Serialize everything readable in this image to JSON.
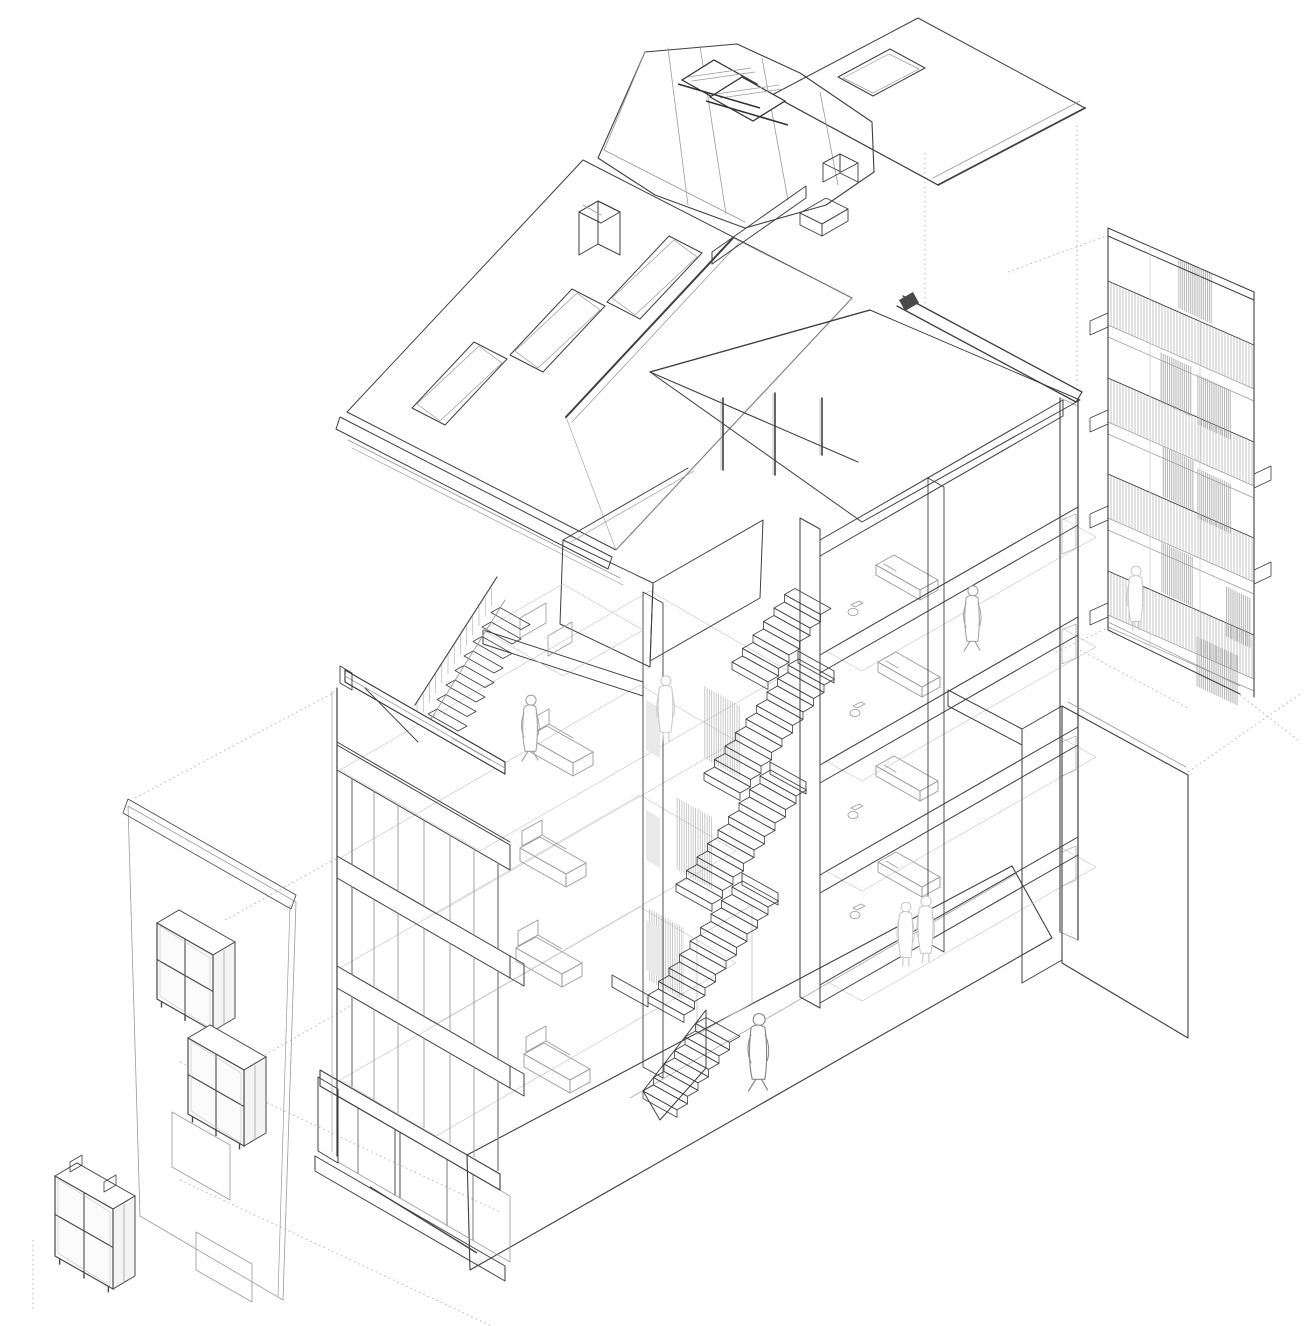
{
  "scene": {
    "title": "Exploded axonometric cutaway drawing of a multi-storey apartment building",
    "type": "architectural line drawing, no text labels",
    "background_color": "#ffffff",
    "ink_color": "#3f3f3f",
    "light_ink_color": "#9a9a9a",
    "faint_ink_color": "#c4c4c4",
    "projection_line_style": "dotted"
  },
  "components": {
    "roof_assembly": {
      "front_tiled_pitch": {
        "skylights": 3,
        "chimneys": 1,
        "tile_type": "scalloped clay tiles",
        "gutter_boards": 2
      },
      "attic_dormer_volume": {
        "finish": "hatched shingle cladding",
        "roof_window_frames": 2,
        "chimney_boxes": 1
      },
      "rear_tiled_pitch": {
        "skylights": 1
      },
      "eaves_beam_bar": 1
    },
    "balcony_screen_facade": {
      "levels": 4,
      "railing": "vertical slat balustrades",
      "louver_screen_panels": 8,
      "support_brackets": true,
      "people_on_balconies": 1
    },
    "main_building": {
      "left_wing": {
        "floors": 4,
        "roof_terrace": true,
        "terrace_parapet": true,
        "loft_stair": true,
        "sofas": 4,
        "glazed_mullion_facade": true
      },
      "stair_core": {
        "flights": 5,
        "landings": 3,
        "slat_screens": 3,
        "door_openings": 3
      },
      "right_wing": {
        "floors": 4,
        "roof": "mono-pitch with ridge beam",
        "beds": 4,
        "toilets": 4,
        "facade_windows": 4
      },
      "ground_floor": {
        "storefront_glazing": true,
        "canopy_fascia": true,
        "plinth": true,
        "door_recess": true
      },
      "courtyard_parapet_terrace": true,
      "floating_steel_beam": 1
    },
    "street_facade_strip": {
      "finish": "brick party wall with coping",
      "window_openings": 2,
      "glazed_bay_window_boxes": 3
    },
    "figures_total": 7
  }
}
